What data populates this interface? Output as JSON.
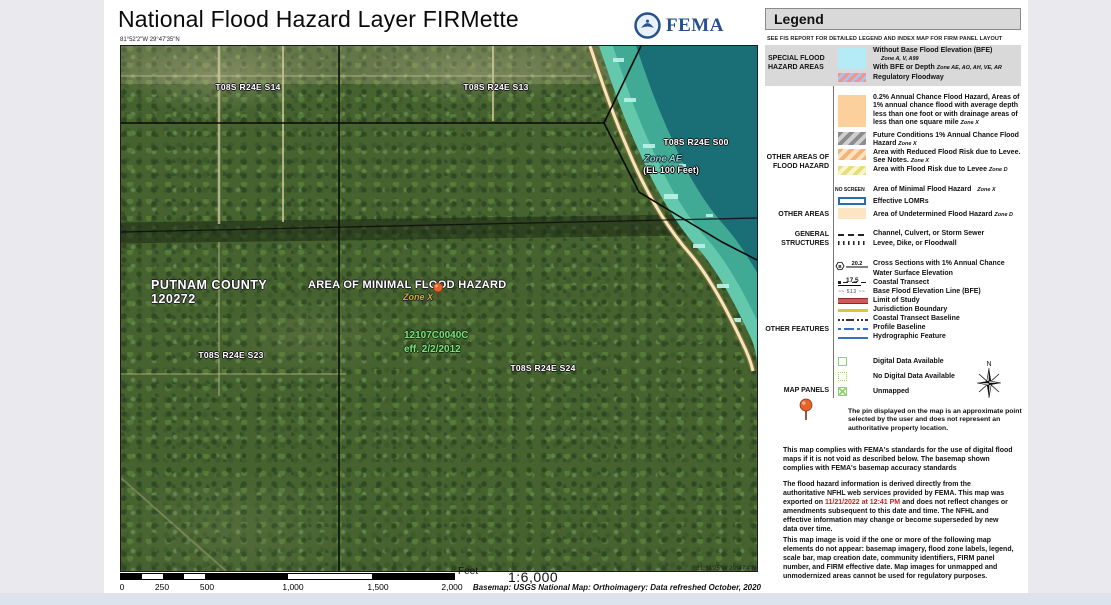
{
  "header": {
    "title": "National Flood Hazard Layer FIRMette",
    "agency": "FEMA"
  },
  "map": {
    "top_left_coords": "81°52'2\"W 29°47'35\"N",
    "bottom_right_coords": "81°51'25\"W 29°47'4\"N",
    "labels": {
      "s14": "T08S R24E S14",
      "s13": "T08S R24E S13",
      "s00": "T08S R24E S00",
      "s23": "T08S R24E S23",
      "s24": "T08S R24E S24",
      "zone_ae": "Zone AE",
      "zone_ae_el": "(EL 100 Feet)",
      "county": "PUTNAM COUNTY",
      "community_id": "120272",
      "minimal_hazard": "AREA OF MINIMAL FLOOD HAZARD",
      "zone_x": "Zone X",
      "firm_panel": "12107C0040C",
      "effective_date": "eff. 2/2/2012"
    }
  },
  "scale": {
    "ticks": [
      "0",
      "250",
      "500",
      "1,000",
      "1,500",
      "2,000"
    ],
    "unit": "Feet",
    "ratio": "1:6,000",
    "basemap": "Basemap: USGS National Map: Orthoimagery: Data refreshed October, 2020"
  },
  "legend": {
    "title": "Legend",
    "subtitle": "SEE FIS REPORT FOR DETAILED LEGEND AND INDEX MAP FOR FIRM PANEL LAYOUT",
    "sfha": {
      "label": "SPECIAL FLOOD HAZARD AREAS",
      "no_bfe": "Without Base Flood Elevation (BFE)",
      "no_bfe_zones": "Zone A, V, A99",
      "bfe": "With BFE or Depth",
      "bfe_zones": "Zone AE, AO, AH, VE, AR",
      "floodway": "Regulatory Floodway"
    },
    "ofh": {
      "label": "OTHER AREAS OF FLOOD HAZARD",
      "rows": [
        {
          "text": "0.2% Annual Chance Flood Hazard, Areas of 1% annual chance flood with average depth less than one foot or with drainage areas of less than one square mile",
          "zone": "Zone X"
        },
        {
          "text": "Future Conditions 1% Annual Chance Flood Hazard",
          "zone": "Zone X"
        },
        {
          "text": "Area with Reduced Flood Risk due to Levee. See Notes.",
          "zone": "Zone X"
        },
        {
          "text": "Area with Flood Risk due to Levee",
          "zone": "Zone D"
        }
      ]
    },
    "other_areas": {
      "label": "OTHER AREAS",
      "no_screen": "NO SCREEN",
      "minimal": "Area of Minimal Flood Hazard",
      "minimal_zone": "Zone X",
      "lomr": "Effective LOMRs",
      "undetermined": "Area of Undetermined Flood Hazard",
      "undetermined_zone": "Zone D"
    },
    "structures": {
      "label": "GENERAL STRUCTURES",
      "channel": "Channel, Culvert, or Storm Sewer",
      "levee": "Levee, Dike, or Floodwall"
    },
    "features": {
      "label": "OTHER FEATURES",
      "cross_section_value": "20.2",
      "cross_section_letter": "B",
      "cross_section": "Cross Sections with 1% Annual Chance",
      "water_surface_value": "17.5",
      "water_surface": "Water Surface Elevation",
      "coastal_transect": "Coastal Transect",
      "bfe_value": "513",
      "bfe_line": "Base Flood Elevation Line (BFE)",
      "limit_of_study": "Limit of Study",
      "jurisdiction": "Jurisdiction Boundary",
      "transect_baseline": "Coastal Transect Baseline",
      "profile_baseline": "Profile Baseline",
      "hydrographic": "Hydrographic Feature"
    },
    "map_panels": {
      "label": "MAP PANELS",
      "digital": "Digital Data Available",
      "no_digital": "No Digital Data Available",
      "unmapped": "Unmapped",
      "north": "N"
    },
    "pin_note": "The pin displayed on the map is an approximate point selected by the user and does not represent an authoritative property location."
  },
  "notes": {
    "p1": "This map complies with FEMA's standards for the use of digital flood maps if it is not void as described below. The basemap shown complies with FEMA's basemap accuracy standards",
    "p2_before": "The flood hazard information is derived directly from the authoritative NFHL web services provided by FEMA. This map was exported on ",
    "p2_date": "11/21/2022 at 12:41 PM",
    "p2_after": " and does not reflect changes or amendments subsequent to this date and time. The NFHL and effective information may change or become superseded by new data over time.",
    "p3": "This map image is void if the one or more of the following map elements do not appear: basemap imagery, flood zone labels, legend, scale bar, map creation date, community identifiers, FIRM panel number, and FIRM effective date. Map images for unmapped and unmodernized areas cannot be used for regulatory purposes."
  },
  "colors": {
    "fema_blue": "#26508e",
    "export_date_red": "#c42222",
    "water_teal": "#1a6f76",
    "zone_ae_band": "#5bcfa8",
    "sfha_cyan": "#b5eaf7",
    "flood_02pct_orange": "#fcd09c",
    "undetermined_tan": "#fbe5c2",
    "lomr_blue": "#2b6cb0",
    "map_panel_green": "#8fd464",
    "pin_orange": "#e8622d"
  }
}
